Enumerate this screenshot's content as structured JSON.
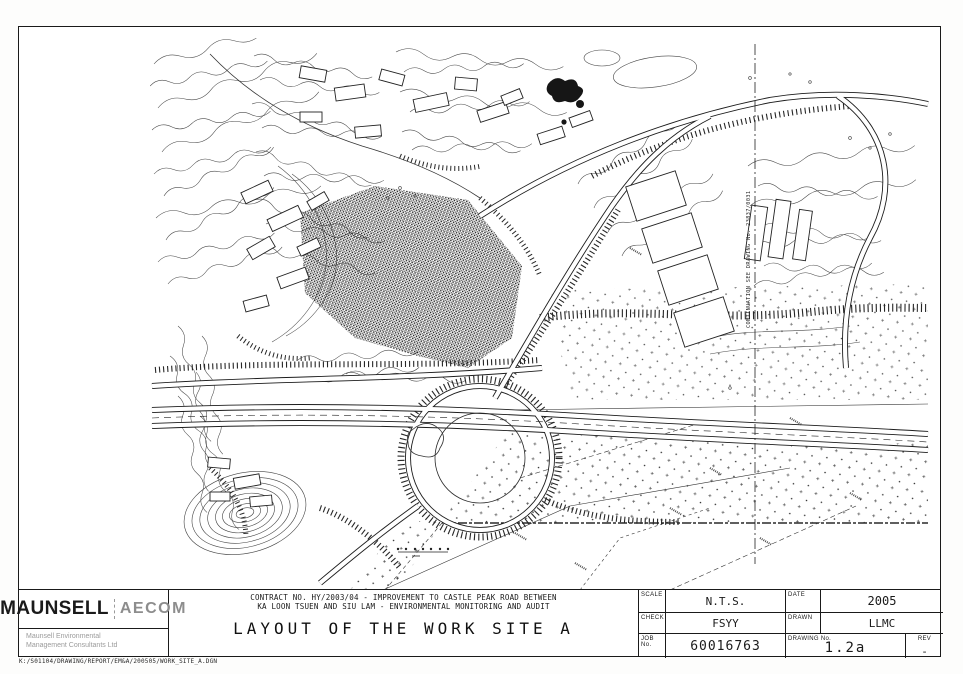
{
  "sheet": {
    "file_path": "K:/S01104/DRAWING/REPORT/EM&A/200505/WORK_SITE_A.DGN"
  },
  "title_block": {
    "logo": {
      "primary": "MAUNSELL",
      "secondary": "AECOM",
      "subtitle_line1": "Maunsell Environmental",
      "subtitle_line2": "Management Consultants Ltd"
    },
    "contract_line1": "CONTRACT NO. HY/2003/04 - IMPROVEMENT TO CASTLE PEAK ROAD BETWEEN",
    "contract_line2": "KA LOON TSUEN AND SIU LAM - ENVIRONMENTAL MONITORING AND AUDIT",
    "drawing_title": "LAYOUT OF THE WORK SITE A",
    "fields": {
      "scale_label": "SCALE",
      "scale_value": "N.T.S.",
      "date_label": "DATE",
      "date_value": "2005",
      "check_label": "CHECK",
      "check_value": "FSYY",
      "drawn_label": "DRAWN",
      "drawn_value": "LLMC",
      "job_label": "JOB No.",
      "job_value": "60016763",
      "drawing_no_label": "DRAWING No.",
      "drawing_no_value": "1.2a",
      "rev_label": "REV",
      "rev_value": "-"
    }
  },
  "map": {
    "continuation_note": "CONTINUATION SEE DRAWING No. 23837/0031",
    "colors": {
      "ink": "#1a1a1a",
      "paper": "#ffffff"
    }
  }
}
